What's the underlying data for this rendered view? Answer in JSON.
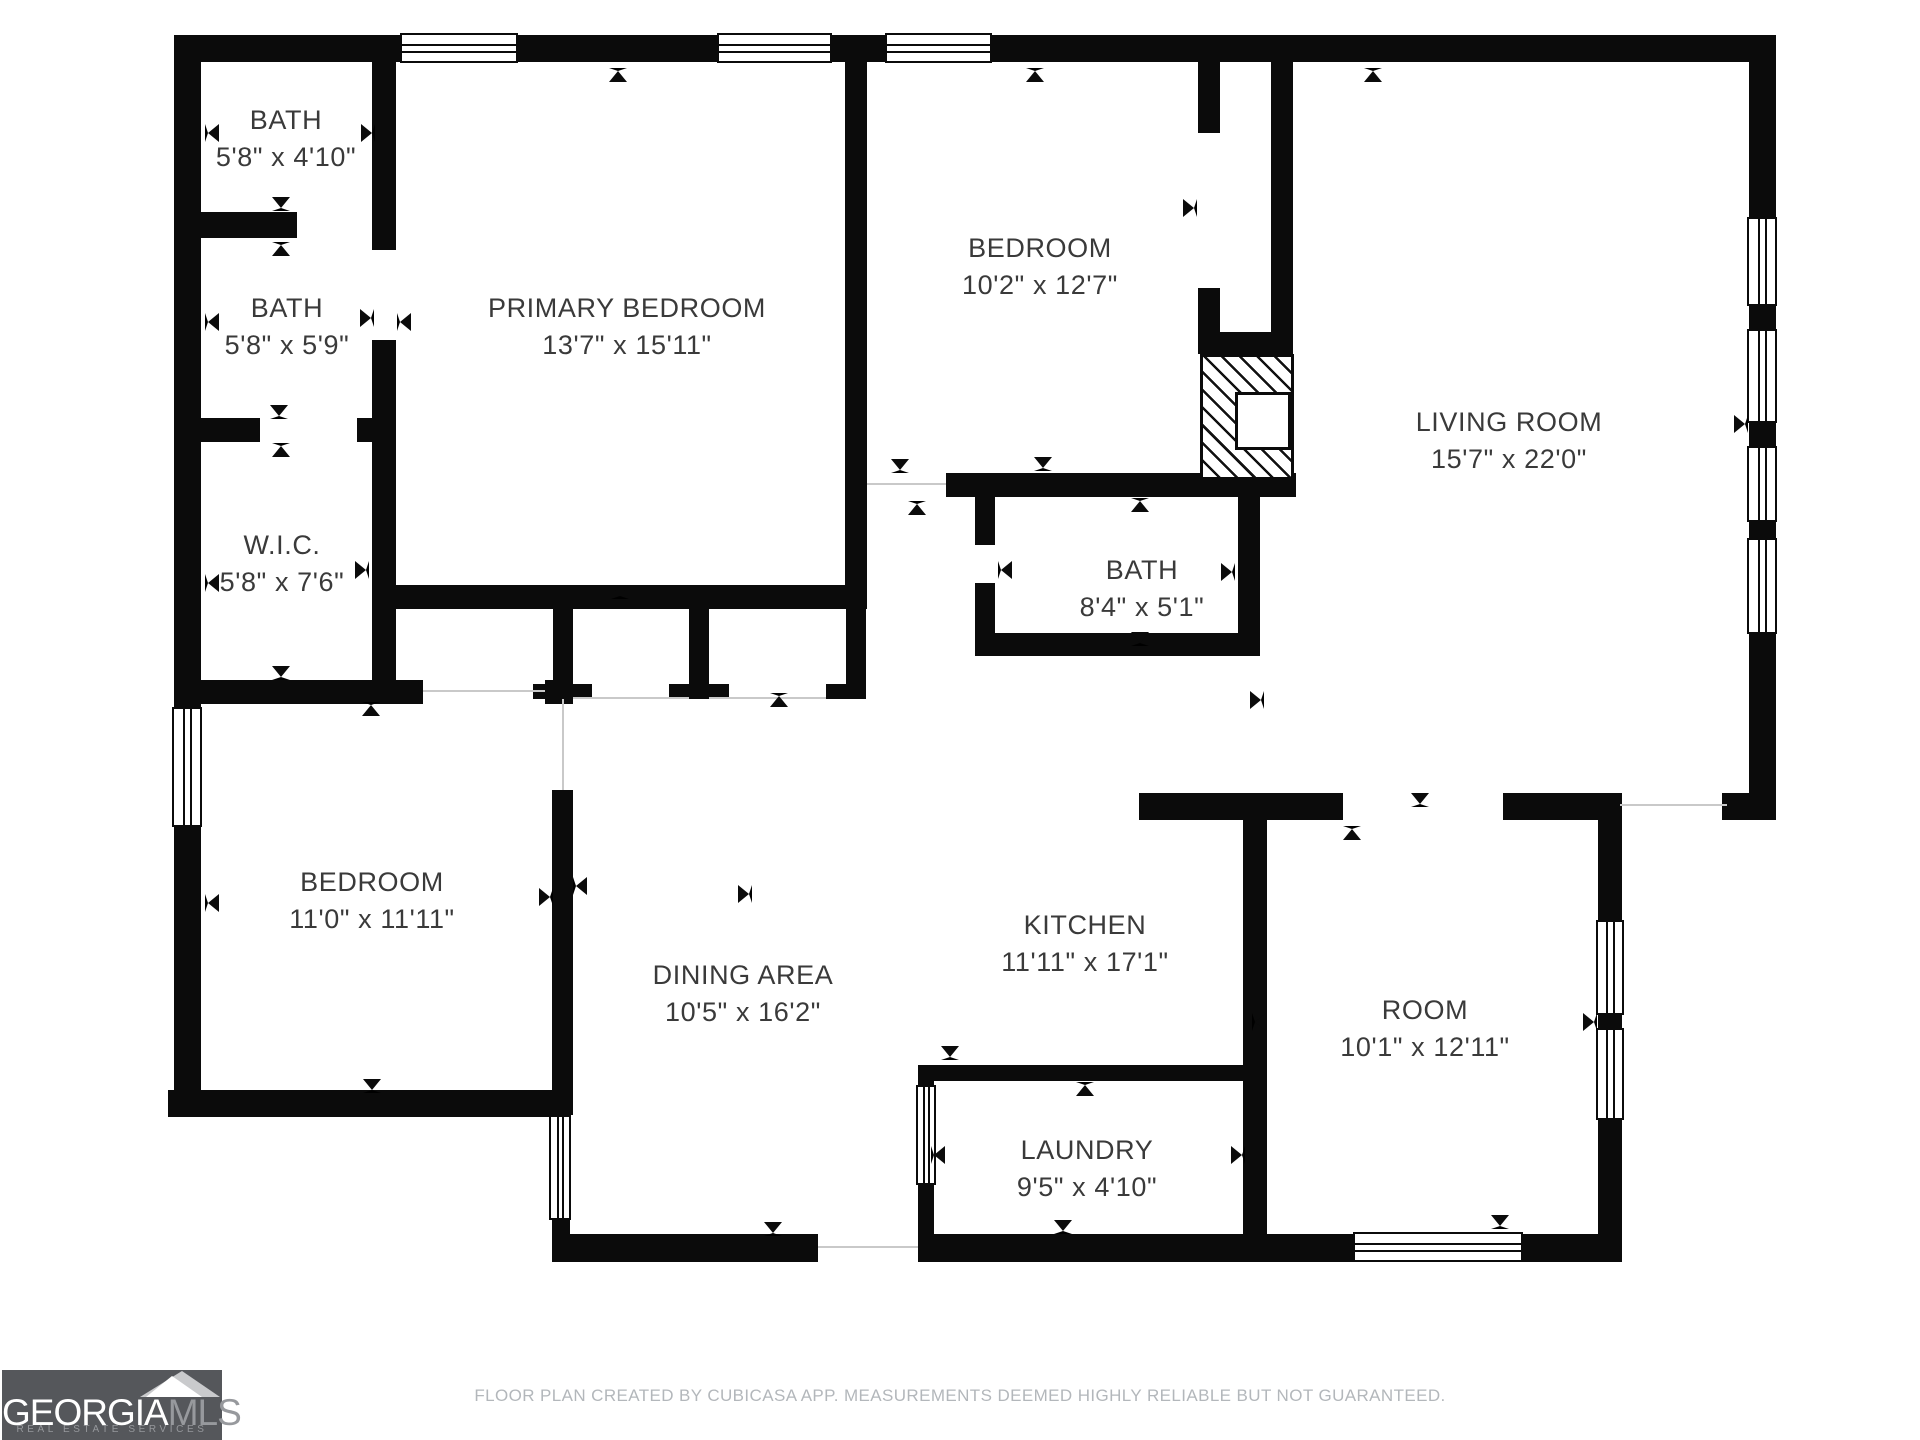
{
  "footer": {
    "text": "FLOOR PLAN CREATED BY CUBICASA APP. MEASUREMENTS DEEMED HIGHLY RELIABLE BUT NOT GUARANTEED."
  },
  "logo": {
    "brand_primary": "GEORGIA",
    "brand_secondary": "MLS",
    "tagline": "REAL ESTATE SERVICES",
    "bg_color": "#55575b",
    "primary_color": "#ffffff",
    "secondary_color": "#97999d"
  },
  "colors": {
    "wall": "#0b0b0b",
    "label": "#3a3a3a",
    "opening_line": "#c9c9c9",
    "background": "#ffffff"
  },
  "rooms": [
    {
      "name": "BATH",
      "dims": "5'8\" x 4'10\"",
      "cx": 286,
      "cy": 120
    },
    {
      "name": "BATH",
      "dims": "5'8\" x 5'9\"",
      "cx": 287,
      "cy": 308
    },
    {
      "name": "W.I.C.",
      "dims": "5'8\" x 7'6\"",
      "cx": 282,
      "cy": 545
    },
    {
      "name": "PRIMARY BEDROOM",
      "dims": "13'7\" x 15'11\"",
      "cx": 627,
      "cy": 308
    },
    {
      "name": "BEDROOM",
      "dims": "10'2\" x 12'7\"",
      "cx": 1040,
      "cy": 248
    },
    {
      "name": "LIVING ROOM",
      "dims": "15'7\" x 22'0\"",
      "cx": 1509,
      "cy": 422
    },
    {
      "name": "BATH",
      "dims": "8'4\" x 5'1\"",
      "cx": 1142,
      "cy": 570
    },
    {
      "name": "BEDROOM",
      "dims": "11'0\" x 11'11\"",
      "cx": 372,
      "cy": 882
    },
    {
      "name": "DINING AREA",
      "dims": "10'5\" x 16'2\"",
      "cx": 743,
      "cy": 975
    },
    {
      "name": "KITCHEN",
      "dims": "11'11\" x 17'1\"",
      "cx": 1085,
      "cy": 925
    },
    {
      "name": "ROOM",
      "dims": "10'1\" x 12'11\"",
      "cx": 1425,
      "cy": 1010
    },
    {
      "name": "LAUNDRY",
      "dims": "9'5\" x 4'10\"",
      "cx": 1087,
      "cy": 1150
    }
  ],
  "walls": [
    [
      174,
      35,
      1602,
      27
    ],
    [
      174,
      35,
      27,
      1082
    ],
    [
      1749,
      35,
      27,
      785
    ],
    [
      1722,
      793,
      54,
      27
    ],
    [
      372,
      35,
      24,
      215
    ],
    [
      372,
      340,
      24,
      340
    ],
    [
      174,
      212,
      123,
      26
    ],
    [
      174,
      418,
      86,
      24
    ],
    [
      357,
      418,
      39,
      24
    ],
    [
      174,
      680,
      249,
      24
    ],
    [
      545,
      680,
      28,
      24
    ],
    [
      552,
      790,
      21,
      325
    ],
    [
      552,
      1220,
      18,
      42
    ],
    [
      168,
      1090,
      400,
      27
    ],
    [
      379,
      585,
      487,
      24
    ],
    [
      845,
      62,
      22,
      547
    ],
    [
      553,
      609,
      20,
      77
    ],
    [
      533,
      684,
      59,
      15
    ],
    [
      689,
      609,
      20,
      77
    ],
    [
      669,
      684,
      60,
      15
    ],
    [
      846,
      609,
      20,
      77
    ],
    [
      826,
      684,
      40,
      15
    ],
    [
      946,
      473,
      350,
      24
    ],
    [
      1198,
      62,
      22,
      71
    ],
    [
      1198,
      288,
      22,
      66
    ],
    [
      1198,
      332,
      95,
      22
    ],
    [
      1271,
      62,
      22,
      270
    ],
    [
      975,
      497,
      20,
      48
    ],
    [
      975,
      583,
      20,
      70
    ],
    [
      975,
      633,
      285,
      23
    ],
    [
      1238,
      480,
      22,
      176
    ],
    [
      1139,
      793,
      204,
      27
    ],
    [
      1503,
      793,
      117,
      27
    ],
    [
      1243,
      793,
      24,
      469
    ],
    [
      1598,
      793,
      24,
      127
    ],
    [
      1598,
      1015,
      24,
      13
    ],
    [
      1598,
      1120,
      24,
      142
    ],
    [
      918,
      1065,
      325,
      16
    ],
    [
      918,
      1065,
      16,
      197
    ],
    [
      552,
      1234,
      266,
      28
    ],
    [
      918,
      1234,
      704,
      28
    ]
  ],
  "windows": [
    [
      400,
      33,
      118,
      30,
      "h"
    ],
    [
      717,
      33,
      115,
      30,
      "h"
    ],
    [
      885,
      33,
      107,
      30,
      "h"
    ],
    [
      172,
      707,
      30,
      120,
      "v"
    ],
    [
      1747,
      217,
      30,
      89,
      "v"
    ],
    [
      1747,
      329,
      30,
      94,
      "v"
    ],
    [
      1747,
      446,
      30,
      76,
      "v"
    ],
    [
      1747,
      538,
      30,
      96,
      "v"
    ],
    [
      1596,
      920,
      28,
      95,
      "v"
    ],
    [
      1596,
      1028,
      28,
      92,
      "v"
    ],
    [
      1353,
      1232,
      170,
      30,
      "h"
    ],
    [
      916,
      1085,
      20,
      100,
      "v"
    ],
    [
      549,
      1115,
      22,
      105,
      "v"
    ]
  ],
  "openings": [
    [
      1620,
      804,
      1727,
      804
    ],
    [
      818,
      1246,
      918,
      1246
    ],
    [
      562,
      699,
      562,
      790
    ],
    [
      573,
      697,
      689,
      697
    ],
    [
      709,
      697,
      826,
      697
    ],
    [
      867,
      483,
      946,
      483
    ],
    [
      423,
      690,
      545,
      690
    ]
  ],
  "ticks": [
    [
      212,
      133,
      "left"
    ],
    [
      368,
      133,
      "right"
    ],
    [
      281,
      204,
      "down"
    ],
    [
      281,
      249,
      "up"
    ],
    [
      212,
      322,
      "left"
    ],
    [
      367,
      318,
      "right"
    ],
    [
      404,
      322,
      "left"
    ],
    [
      279,
      412,
      "down"
    ],
    [
      281,
      450,
      "up"
    ],
    [
      212,
      583,
      "left"
    ],
    [
      362,
      570,
      "right"
    ],
    [
      281,
      673,
      "down"
    ],
    [
      371,
      709,
      "up"
    ],
    [
      618,
      75,
      "up"
    ],
    [
      620,
      592,
      "down"
    ],
    [
      779,
      700,
      "up"
    ],
    [
      212,
      903,
      "left"
    ],
    [
      546,
      897,
      "right"
    ],
    [
      580,
      886,
      "left"
    ],
    [
      372,
      1086,
      "down"
    ],
    [
      1035,
      75,
      "up"
    ],
    [
      900,
      466,
      "down"
    ],
    [
      917,
      508,
      "up"
    ],
    [
      1043,
      464,
      "down"
    ],
    [
      1190,
      208,
      "right"
    ],
    [
      1373,
      75,
      "up"
    ],
    [
      1741,
      424,
      "right"
    ],
    [
      1140,
      505,
      "up"
    ],
    [
      1005,
      570,
      "left"
    ],
    [
      1228,
      572,
      "right"
    ],
    [
      1140,
      639,
      "down"
    ],
    [
      1257,
      700,
      "right"
    ],
    [
      1420,
      800,
      "down"
    ],
    [
      1352,
      833,
      "up"
    ],
    [
      1259,
      1022,
      "left"
    ],
    [
      1590,
      1022,
      "right"
    ],
    [
      950,
      1053,
      "down"
    ],
    [
      1085,
      1089,
      "up"
    ],
    [
      938,
      1155,
      "left"
    ],
    [
      1238,
      1155,
      "right"
    ],
    [
      1063,
      1227,
      "down"
    ],
    [
      745,
      894,
      "right"
    ],
    [
      773,
      1229,
      "down"
    ],
    [
      1500,
      1222,
      "down"
    ]
  ],
  "fireplace": {
    "x": 1200,
    "y": 354,
    "w": 94,
    "h": 126,
    "inset": {
      "x": 1235,
      "y": 392,
      "w": 56,
      "h": 58
    }
  }
}
